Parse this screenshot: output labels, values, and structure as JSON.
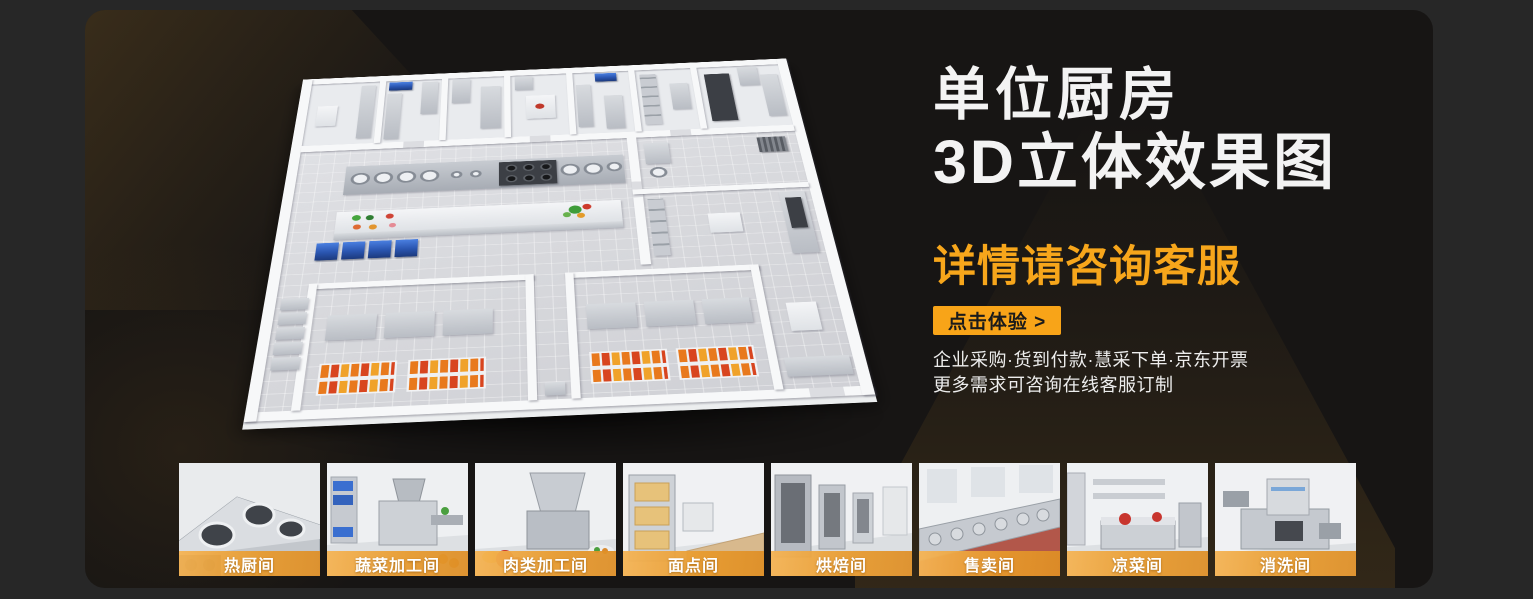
{
  "hero": {
    "title_line1": "单位厨房",
    "title_line2": "3D立体效果图",
    "subtitle": "详情请咨询客服",
    "cta_label": "点击体验 >",
    "note_line1": "企业采购·货到付款·慧采下单·京东开票",
    "note_line2": "更多需求可咨询在线客服订制"
  },
  "floorplan": {
    "illustration_name": "3d-kitchen-floorplan"
  },
  "thumbnails": [
    {
      "label": "热厨间"
    },
    {
      "label": "蔬菜加工间"
    },
    {
      "label": "肉类加工间"
    },
    {
      "label": "面点间"
    },
    {
      "label": "烘焙间"
    },
    {
      "label": "售卖间"
    },
    {
      "label": "凉菜间"
    },
    {
      "label": "消洗间"
    }
  ],
  "colors": {
    "accent_orange": "#F8A418",
    "page_bg": "#272727",
    "panel_bg": "#171514",
    "title_white": "#F3F3F3"
  }
}
